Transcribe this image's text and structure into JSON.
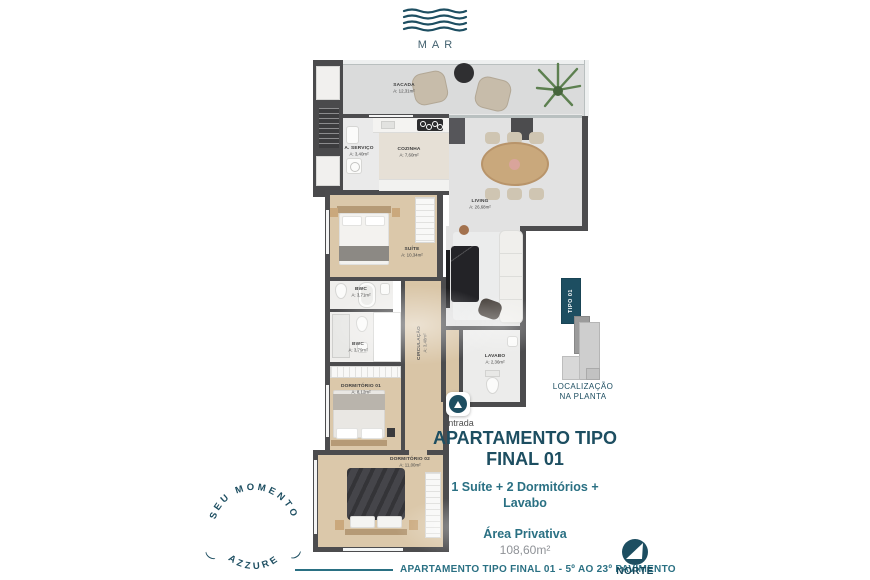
{
  "brand": {
    "logo_text": "MAR"
  },
  "floor_plan": {
    "rooms": [
      {
        "name": "SACADA",
        "area": "A: 12,31m²"
      },
      {
        "name": "A. SERVIÇO",
        "area": "A: 3,40m²"
      },
      {
        "name": "COZINHA",
        "area": "A: 7,60m²"
      },
      {
        "name": "LIVING",
        "area": "A: 26,68m²"
      },
      {
        "name": "SUÍTE",
        "area": "A: 10,34m²"
      },
      {
        "name": "BWC",
        "area": "A: 3,71m²"
      },
      {
        "name": "BWC",
        "area": "A: 3,79m²"
      },
      {
        "name": "CIRCULAÇÃO",
        "area": "A: 3,48m²"
      },
      {
        "name": "LAVABO",
        "area": "A: 2,36m²"
      },
      {
        "name": "DORMITÓRIO 01",
        "area": "A: 8,12m²"
      },
      {
        "name": "DORMITÓRIO 02",
        "area": "A: 11,00m²"
      }
    ],
    "entrance_label": "Entrada"
  },
  "location_diagram": {
    "unit_label": "TIPO 01",
    "caption_line1": "LOCALIZAÇÃO",
    "caption_line2": "NA PLANTA"
  },
  "unit_info": {
    "title_line1": "APARTAMENTO TIPO",
    "title_line2": "FINAL 01",
    "features_line1": "1 Suíte + 2 Dormitórios +",
    "features_line2": "Lavabo",
    "area_label": "Área Privativa",
    "area_value": "108,60m²"
  },
  "stamp": {
    "arc_top": "SEU MOMENTO",
    "arc_bottom": "AZZURE",
    "decor_open": "(",
    "decor_close": ")"
  },
  "footer": {
    "caption": "APARTAMENTO TIPO FINAL 01 - 5º AO 23º PAVIMENTO",
    "compass_label": "NORTE"
  },
  "colors": {
    "primary_teal": "#1d4e61",
    "secondary_teal": "#2a7083",
    "text_gray": "#8f9297"
  }
}
